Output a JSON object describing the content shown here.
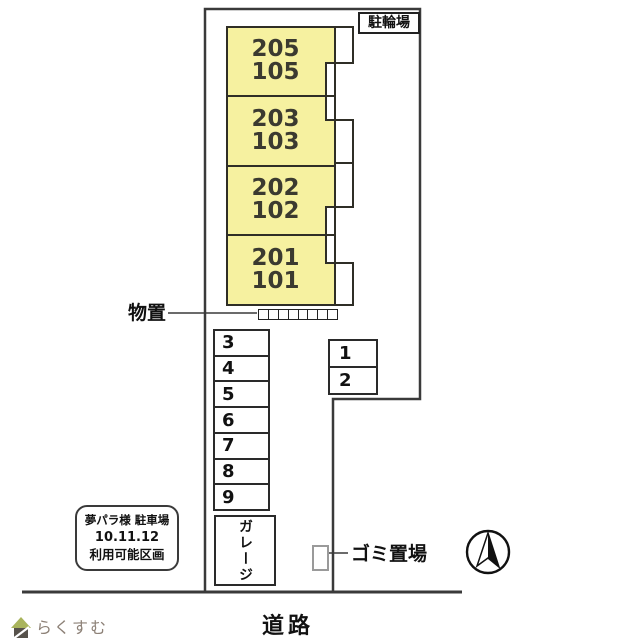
{
  "plan": {
    "bicycle_area_label": "駐輪場",
    "building_units": [
      {
        "upper": "205",
        "lower": "105"
      },
      {
        "upper": "203",
        "lower": "103"
      },
      {
        "upper": "202",
        "lower": "102"
      },
      {
        "upper": "201",
        "lower": "101"
      }
    ],
    "storage": {
      "label": "物置",
      "cells": 8
    },
    "parking_column": [
      "3",
      "4",
      "5",
      "6",
      "7",
      "8",
      "9"
    ],
    "parking_pair": [
      "1",
      "2"
    ],
    "garage_label": "ガレージ",
    "garbage_area_label": "ゴミ置場",
    "road_label": "道路",
    "notice_box": {
      "line1": "夢パラ様 駐車場",
      "line2": "10.11.12",
      "line3": "利用可能区画"
    },
    "compass_direction": "north"
  },
  "watermark": {
    "brand": "らくすむ"
  },
  "colors": {
    "building_fill": "#f6f1a0",
    "building_stroke": "#2f2e26",
    "boundary_line": "#3a3a3a",
    "garbage_rect_border": "#9a9a9a",
    "logo_roof_green": "#a9b45c",
    "logo_base_gray": "#57524b",
    "watermark_text": "#8d8177"
  }
}
